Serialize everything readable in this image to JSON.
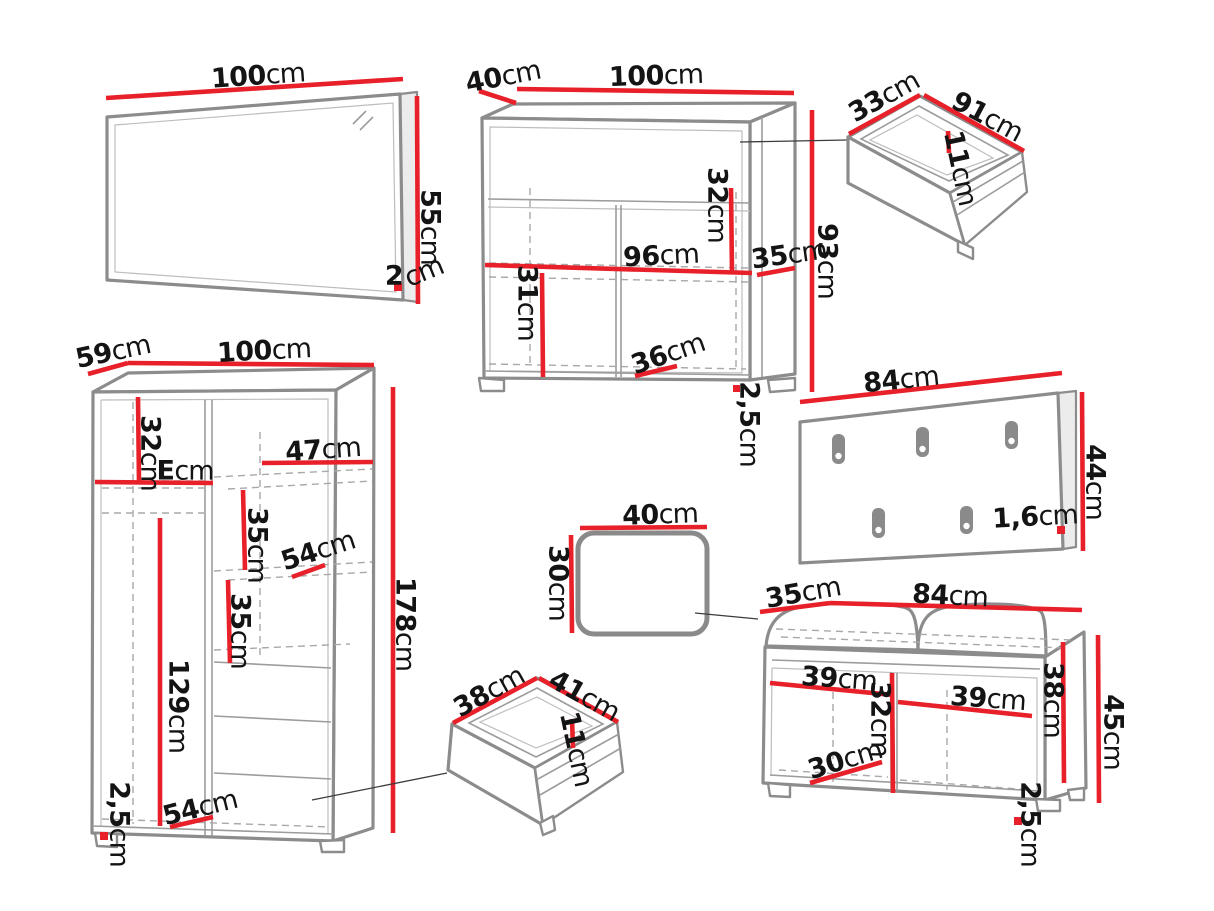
{
  "unit": "cm",
  "colors": {
    "dimension": "#e8202a",
    "outline": "#8c8c8c",
    "text": "#141414"
  },
  "pieces": {
    "mirror": {
      "dimensions": {
        "width": "100",
        "height": "55",
        "depth": "2"
      }
    },
    "chest_of_drawers": {
      "dimensions": {
        "depth": "40",
        "width": "100",
        "height": "93",
        "drawer_inner_height": "32",
        "inner_width": "96",
        "shelf_side": "35",
        "lower_inner_height": "31",
        "compartment_width": "36",
        "plinth_height": "2,5"
      }
    },
    "drawer_large": {
      "dimensions": {
        "depth": "33",
        "width": "91",
        "inner_height": "11"
      }
    },
    "coat_rack": {
      "hook_count": 5,
      "dimensions": {
        "width": "84",
        "height": "44",
        "thickness": "1,6"
      }
    },
    "wardrobe": {
      "dimensions": {
        "depth": "59",
        "width": "100",
        "height": "178",
        "top_shelf_height": "32",
        "shelf_width_right": "47",
        "shelf_width_left": "E",
        "shelf_gap_upper": "35",
        "shelf_depth_upper": "54",
        "shelf_gap_lower": "35",
        "hanging_space_height": "129",
        "shelf_depth_lower": "54",
        "plinth_height": "2,5"
      }
    },
    "stool": {
      "dimensions": {
        "width": "40",
        "height": "30"
      }
    },
    "drawer_small": {
      "dimensions": {
        "depth": "38",
        "width": "41",
        "inner_height": "11"
      }
    },
    "bench": {
      "dimensions": {
        "depth": "35",
        "width": "84",
        "height": "45",
        "compartment_width_left": "39",
        "compartment_width_right": "39",
        "inner_height_side": "38",
        "inner_height_center": "32",
        "compartment_depth": "30",
        "plinth_height": "2,5"
      }
    }
  }
}
